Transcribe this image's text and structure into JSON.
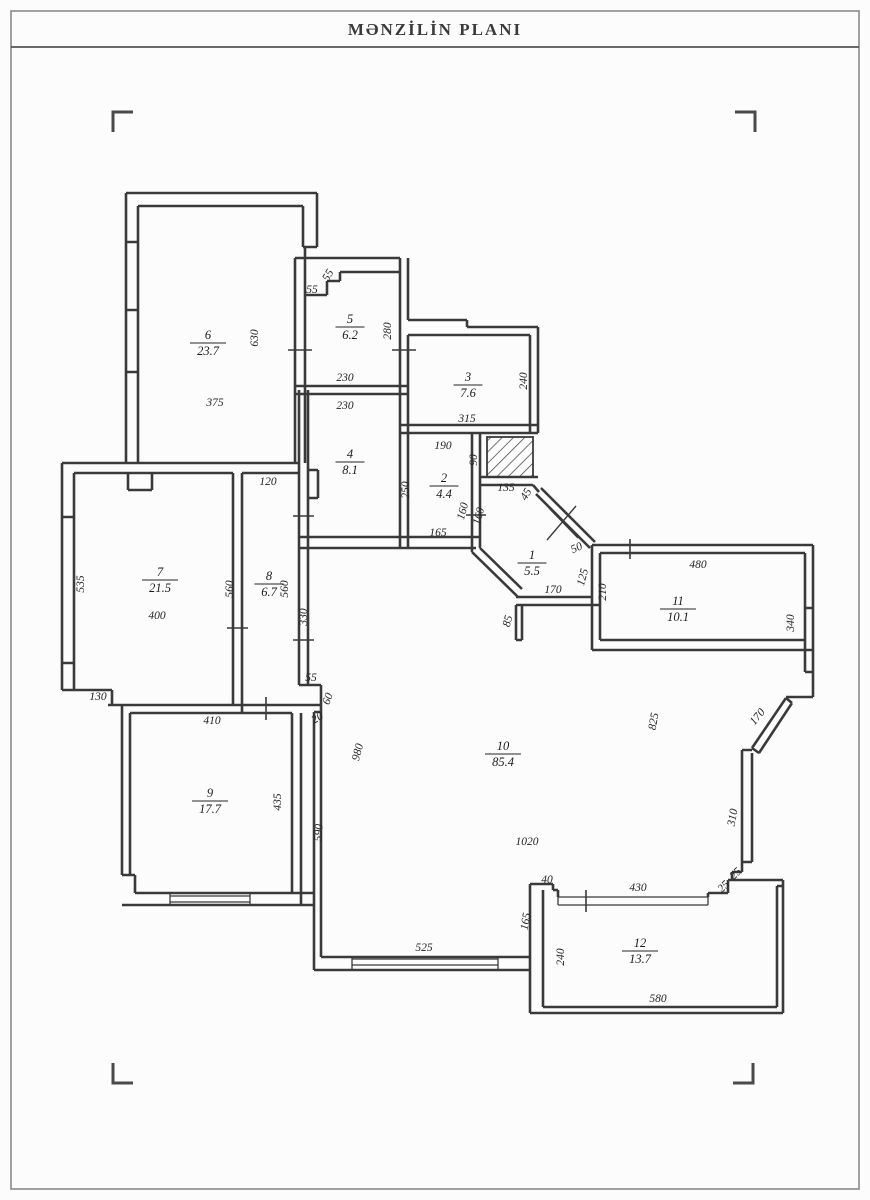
{
  "title": "MƏNZİLİN PLANI",
  "colors": {
    "wall": "#3a3a3a",
    "text": "#242424",
    "page": "#fcfcfc"
  },
  "plan": {
    "rooms": [
      {
        "number": "1",
        "area": "5.5",
        "x": 532,
        "y": 563
      },
      {
        "number": "2",
        "area": "4.4",
        "x": 444,
        "y": 486
      },
      {
        "number": "3",
        "area": "7.6",
        "x": 468,
        "y": 385
      },
      {
        "number": "4",
        "area": "8.1",
        "x": 350,
        "y": 462
      },
      {
        "number": "5",
        "area": "6.2",
        "x": 350,
        "y": 327
      },
      {
        "number": "6",
        "area": "23.7",
        "x": 208,
        "y": 343
      },
      {
        "number": "7",
        "area": "21.5",
        "x": 160,
        "y": 580
      },
      {
        "number": "8",
        "area": "6.7",
        "x": 269,
        "y": 584
      },
      {
        "number": "9",
        "area": "17.7",
        "x": 210,
        "y": 801
      },
      {
        "number": "10",
        "area": "85.4",
        "x": 503,
        "y": 754
      },
      {
        "number": "11",
        "area": "10.1",
        "x": 678,
        "y": 609
      },
      {
        "number": "12",
        "area": "13.7",
        "x": 640,
        "y": 951
      }
    ],
    "dimensions": [
      {
        "t": "630",
        "x": 258,
        "y": 338,
        "r": -90
      },
      {
        "t": "375",
        "x": 215,
        "y": 406,
        "r": 0
      },
      {
        "t": "55",
        "x": 312,
        "y": 293,
        "r": 0
      },
      {
        "t": "55",
        "x": 331,
        "y": 277,
        "r": -60
      },
      {
        "t": "230",
        "x": 345,
        "y": 381,
        "r": 0
      },
      {
        "t": "230",
        "x": 345,
        "y": 409,
        "r": 0
      },
      {
        "t": "280",
        "x": 391,
        "y": 331,
        "r": -90
      },
      {
        "t": "240",
        "x": 527,
        "y": 381,
        "r": -90
      },
      {
        "t": "315",
        "x": 467,
        "y": 422,
        "r": 0
      },
      {
        "t": "190",
        "x": 443,
        "y": 449,
        "r": 0
      },
      {
        "t": "90",
        "x": 477,
        "y": 460,
        "r": -90
      },
      {
        "t": "250",
        "x": 409,
        "y": 490,
        "r": -90
      },
      {
        "t": "160",
        "x": 466,
        "y": 512,
        "r": -75
      },
      {
        "t": "160",
        "x": 482,
        "y": 517,
        "r": -75
      },
      {
        "t": "165",
        "x": 438,
        "y": 536,
        "r": 0
      },
      {
        "t": "135",
        "x": 506,
        "y": 491,
        "r": 0
      },
      {
        "t": "45",
        "x": 529,
        "y": 496,
        "r": -60
      },
      {
        "t": "50",
        "x": 578,
        "y": 551,
        "r": -25
      },
      {
        "t": "125",
        "x": 586,
        "y": 578,
        "r": -75
      },
      {
        "t": "170",
        "x": 553,
        "y": 593,
        "r": 0
      },
      {
        "t": "85",
        "x": 511,
        "y": 622,
        "r": -75
      },
      {
        "t": "210",
        "x": 606,
        "y": 592,
        "r": -90
      },
      {
        "t": "480",
        "x": 698,
        "y": 568,
        "r": 0
      },
      {
        "t": "340",
        "x": 794,
        "y": 623,
        "r": -90
      },
      {
        "t": "120",
        "x": 268,
        "y": 485,
        "r": 0
      },
      {
        "t": "535",
        "x": 84,
        "y": 584,
        "r": -90
      },
      {
        "t": "400",
        "x": 157,
        "y": 619,
        "r": 0
      },
      {
        "t": "560",
        "x": 233,
        "y": 589,
        "r": -90
      },
      {
        "t": "560",
        "x": 288,
        "y": 589,
        "r": -90
      },
      {
        "t": "330",
        "x": 307,
        "y": 617,
        "r": -90
      },
      {
        "t": "130",
        "x": 98,
        "y": 700,
        "r": 0
      },
      {
        "t": "410",
        "x": 212,
        "y": 724,
        "r": 0
      },
      {
        "t": "435",
        "x": 281,
        "y": 802,
        "r": -90
      },
      {
        "t": "590",
        "x": 322,
        "y": 833,
        "r": -85
      },
      {
        "t": "55",
        "x": 311,
        "y": 681,
        "r": 0
      },
      {
        "t": "60",
        "x": 331,
        "y": 700,
        "r": -70
      },
      {
        "t": "20",
        "x": 319,
        "y": 721,
        "r": -30
      },
      {
        "t": "980",
        "x": 361,
        "y": 753,
        "r": -75
      },
      {
        "t": "1020",
        "x": 527,
        "y": 845,
        "r": 0
      },
      {
        "t": "825",
        "x": 657,
        "y": 722,
        "r": -80
      },
      {
        "t": "170",
        "x": 760,
        "y": 719,
        "r": -50
      },
      {
        "t": "310",
        "x": 736,
        "y": 818,
        "r": -80
      },
      {
        "t": "25",
        "x": 738,
        "y": 876,
        "r": -45
      },
      {
        "t": "25",
        "x": 726,
        "y": 889,
        "r": -45
      },
      {
        "t": "430",
        "x": 638,
        "y": 891,
        "r": 0
      },
      {
        "t": "40",
        "x": 547,
        "y": 883,
        "r": 0
      },
      {
        "t": "165",
        "x": 529,
        "y": 922,
        "r": -80
      },
      {
        "t": "240",
        "x": 564,
        "y": 957,
        "r": -90
      },
      {
        "t": "525",
        "x": 424,
        "y": 951,
        "r": 0
      },
      {
        "t": "580",
        "x": 658,
        "y": 1002,
        "r": 0
      }
    ]
  }
}
